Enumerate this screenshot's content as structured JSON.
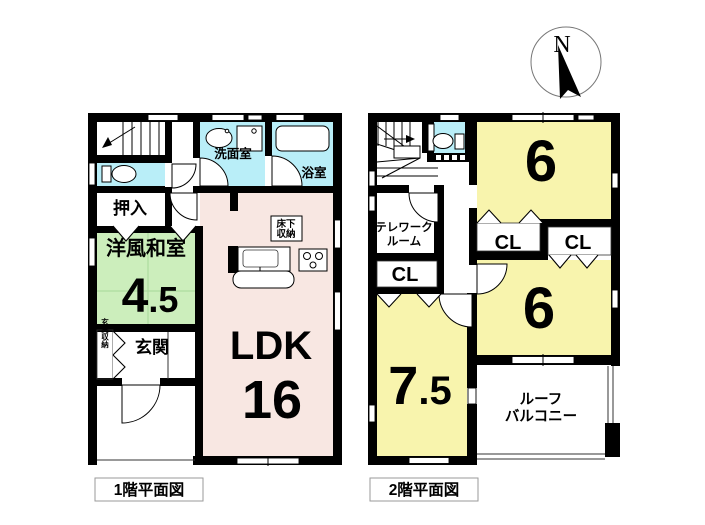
{
  "palette": {
    "wall": "#000000",
    "ldk_pink": "#f8e7e2",
    "washitsu_green": "#cceebc",
    "bedroom_yellow": "#f8f4ad",
    "wet_area_cyan": "#b9eef8",
    "bathtub_cyan": "#a0e7f3"
  },
  "compass": {
    "north_label": "N"
  },
  "floor1": {
    "caption": "1階平面図",
    "labels": {
      "oshiire": "押入",
      "washitsu_name": "洋風和室",
      "washitsu_size_int": "4",
      "washitsu_size_frac": ".5",
      "genkan": "玄関",
      "genkan_storage": "玄関収納",
      "senmenshitsu": "洗面室",
      "yokushitsu": "浴室",
      "yukashita_1": "床下",
      "yukashita_2": "収納",
      "ldk_name": "LDK",
      "ldk_size": "16"
    }
  },
  "floor2": {
    "caption": "2階平面図",
    "labels": {
      "telework_1": "テレワーク",
      "telework_2": "ルーム",
      "cl_left": "CL",
      "cl_mid": "CL",
      "cl_right": "CL",
      "room6_top": "6",
      "room6_bottom": "6",
      "room75_int": "7",
      "room75_frac": ".5",
      "balcony_1": "ルーフ",
      "balcony_2": "バルコニー"
    }
  }
}
